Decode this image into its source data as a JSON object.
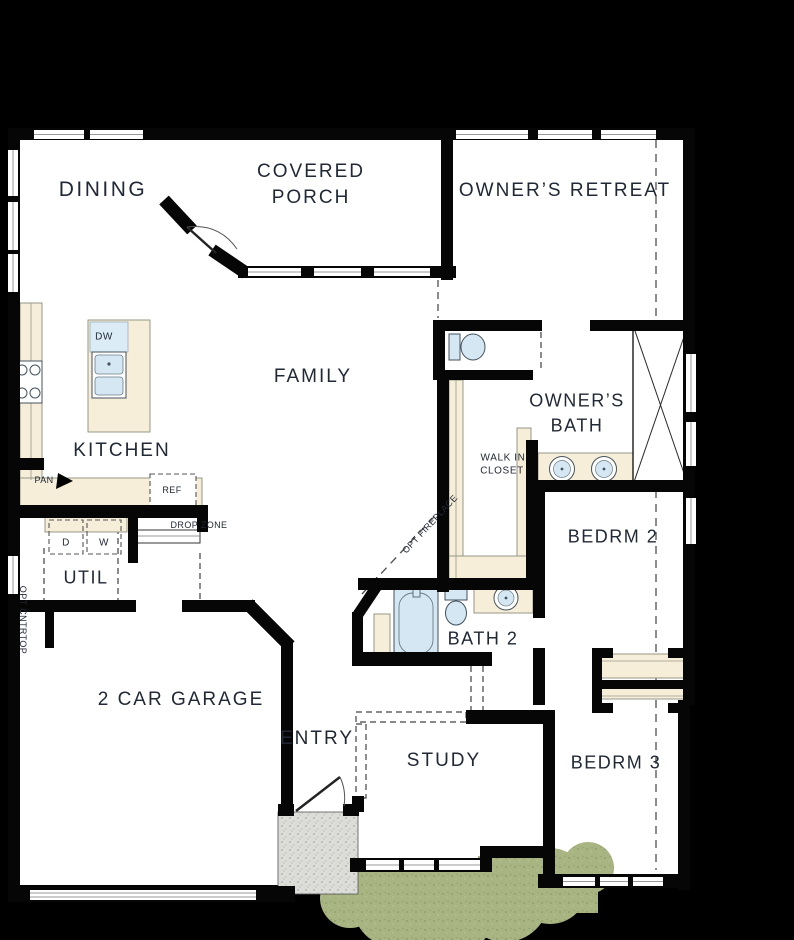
{
  "plan": {
    "rooms": {
      "dining": "DINING",
      "covered_porch_line1": "COVERED",
      "covered_porch_line2": "PORCH",
      "owners_retreat": "OWNER’S RETREAT",
      "family": "FAMILY",
      "kitchen": "KITCHEN",
      "owners_bath_line1": "OWNER’S",
      "owners_bath_line2": "BATH",
      "walk_in_closet_line1": "WALK IN",
      "walk_in_closet_line2": "CLOSET",
      "bedrm2": "BEDRM 2",
      "util": "UTIL",
      "garage": "2 CAR GARAGE",
      "entry": "ENTRY",
      "study": "STUDY",
      "bath2": "BATH 2",
      "bedrm3": "BEDRM 3"
    },
    "annotations": {
      "dw": "DW",
      "pan": "PAN",
      "ref": "REF",
      "drop_zone": "DROP ZONE",
      "dryer": "D",
      "washer": "W",
      "opt_fireplace": "OPT FIREPLACE",
      "opt_cntrtop": "OPT CNTRTOP"
    },
    "colors": {
      "background": "#000000",
      "wall": "#060606",
      "floor": "#ffffff",
      "counter": "#f6eed9",
      "fixture_blue": "#d4e7f2",
      "stoop_gray": "#dcdcd8",
      "shrub_green": "#a9b483",
      "label_text": "#212936",
      "dashed_line": "#6f6f6f"
    }
  }
}
